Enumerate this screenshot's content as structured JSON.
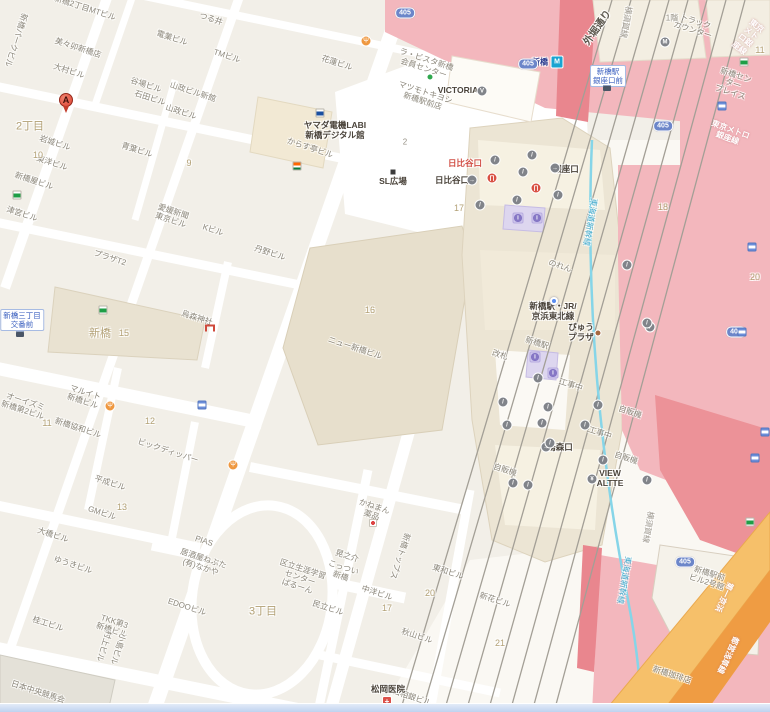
{
  "map": {
    "route_shield_label": "405",
    "metro_badge": {
      "glyph": "M",
      "x": 557,
      "y": 62
    },
    "route_shields": [
      {
        "x": 405,
        "y": 13
      },
      {
        "x": 528,
        "y": 64
      },
      {
        "x": 663,
        "y": 126
      },
      {
        "x": 736,
        "y": 332
      },
      {
        "x": 685,
        "y": 562
      }
    ],
    "labels": [
      {
        "t": "新橋2丁目MTビル",
        "x": 85,
        "y": 8
      },
      {
        "t": "美々卯新橋店",
        "x": 78,
        "y": 48
      },
      {
        "t": "大村ビル",
        "x": 69,
        "y": 71
      },
      {
        "t": "新橋パークビル",
        "x": 16,
        "y": 40,
        "r": 108
      },
      {
        "t": "電業ビル",
        "x": 172,
        "y": 38
      },
      {
        "t": "谷場ビル",
        "x": 146,
        "y": 85
      },
      {
        "t": "石田ビル",
        "x": 150,
        "y": 98
      },
      {
        "t": "山政ビル新館",
        "x": 193,
        "y": 92
      },
      {
        "t": "山政ビル",
        "x": 181,
        "y": 112
      },
      {
        "t": "青葉ビル",
        "x": 137,
        "y": 150
      },
      {
        "t": "岩城ビル",
        "x": 55,
        "y": 143
      },
      {
        "t": "東洋ビル",
        "x": 52,
        "y": 163
      },
      {
        "t": "新橋屋ビル",
        "x": 34,
        "y": 181
      },
      {
        "t": "津宮ビル",
        "x": 22,
        "y": 214
      },
      {
        "t": "Kビル",
        "x": 213,
        "y": 230
      },
      {
        "t": "愛媛新聞\n東京ビル",
        "x": 172,
        "y": 216
      },
      {
        "t": "つる井",
        "x": 211,
        "y": 19
      },
      {
        "t": "TMビル",
        "x": 227,
        "y": 56
      },
      {
        "t": "花蓮ビル",
        "x": 337,
        "y": 63
      },
      {
        "t": "からす亭ビル",
        "x": 310,
        "y": 148
      },
      {
        "t": "プラザT2",
        "x": 110,
        "y": 258
      },
      {
        "t": "マルイト\n新橋ビル",
        "x": 84,
        "y": 397
      },
      {
        "t": "オーイズミ\n新橋第2ビル",
        "x": 24,
        "y": 406
      },
      {
        "t": "ビックディッパー",
        "x": 168,
        "y": 451
      },
      {
        "t": "新橋協和ビル",
        "x": 78,
        "y": 428
      },
      {
        "t": "GMビル",
        "x": 102,
        "y": 513
      },
      {
        "t": "平成ビル",
        "x": 110,
        "y": 483
      },
      {
        "t": "大橋ビル",
        "x": 53,
        "y": 535
      },
      {
        "t": "ゆうきビル",
        "x": 73,
        "y": 565
      },
      {
        "t": "桂工ビル",
        "x": 48,
        "y": 624
      },
      {
        "t": "TKK第3\n新橋ビル",
        "x": 113,
        "y": 626
      },
      {
        "t": "村上ビル",
        "x": 104,
        "y": 646,
        "r": 108
      },
      {
        "t": "小島ビル",
        "x": 118,
        "y": 649,
        "r": 108
      },
      {
        "t": "日本中央競馬会",
        "x": 38,
        "y": 692
      },
      {
        "t": "EDOOビル",
        "x": 187,
        "y": 607
      },
      {
        "t": "PIAS",
        "x": 204,
        "y": 541
      },
      {
        "t": "居酒屋ねぶた\n(有)なかや",
        "x": 202,
        "y": 563
      },
      {
        "t": "かねまん\n薬品",
        "x": 373,
        "y": 511
      },
      {
        "t": "新橋トップス",
        "x": 400,
        "y": 556,
        "r": 108
      },
      {
        "t": "東和ビル",
        "x": 448,
        "y": 572
      },
      {
        "t": "中洋ビル",
        "x": 377,
        "y": 593
      },
      {
        "t": "秋山ビル",
        "x": 417,
        "y": 636
      },
      {
        "t": "新花ビル",
        "x": 495,
        "y": 600
      },
      {
        "t": "西口相銀ビル",
        "x": 408,
        "y": 696
      },
      {
        "t": "区立生涯学習\nセンター\nばるーん",
        "x": 300,
        "y": 578
      },
      {
        "t": "こっつい\n新橋",
        "x": 342,
        "y": 572
      },
      {
        "t": "晃之介",
        "x": 347,
        "y": 556
      },
      {
        "t": "民立ビル",
        "x": 328,
        "y": 608
      },
      {
        "t": "ニュー新橋ビル",
        "x": 355,
        "y": 348
      },
      {
        "t": "丹野ビル",
        "x": 270,
        "y": 253
      },
      {
        "t": "新橋駅前\nビル2号館",
        "x": 708,
        "y": 578
      },
      {
        "t": "新橋センター\nプレイス",
        "x": 733,
        "y": 84
      },
      {
        "t": "トラック\nカウンター",
        "x": 694,
        "y": 26
      },
      {
        "t": "ラ・ビスタ新橋\n会員センター",
        "x": 425,
        "y": 64
      },
      {
        "t": "マツモトキヨシ\n新橋駅前店",
        "x": 424,
        "y": 97
      },
      {
        "t": "新橋珈琲店",
        "x": 672,
        "y": 675
      },
      {
        "t": "のれん",
        "x": 560,
        "y": 266
      },
      {
        "t": "新橋駅",
        "x": 537,
        "y": 343
      },
      {
        "t": "改札",
        "x": 500,
        "y": 355
      },
      {
        "t": "工事中",
        "x": 571,
        "y": 385
      },
      {
        "t": "工事中",
        "x": 600,
        "y": 433
      },
      {
        "t": "自販機",
        "x": 630,
        "y": 412
      },
      {
        "t": "自販機",
        "x": 626,
        "y": 458
      },
      {
        "t": "自販機",
        "x": 505,
        "y": 470
      },
      {
        "t": "烏森神社",
        "x": 197,
        "y": 318
      },
      {
        "t": "ヤマダ電機LABI\n新橋デジタル館",
        "x": 335,
        "y": 131,
        "s": "p"
      },
      {
        "t": "SL広場",
        "x": 393,
        "y": 182,
        "s": "p"
      },
      {
        "t": "VICTORIA",
        "x": 458,
        "y": 91,
        "s": "p"
      },
      {
        "t": "日比谷口",
        "x": 452,
        "y": 181,
        "s": "p"
      },
      {
        "t": "銀座口",
        "x": 566,
        "y": 170,
        "s": "p"
      },
      {
        "t": "烏森口",
        "x": 560,
        "y": 448,
        "s": "p"
      },
      {
        "t": "新橋駅・JR/\n京浜東北線",
        "x": 553,
        "y": 312,
        "s": "p"
      },
      {
        "t": "びゅう\nプラザ",
        "x": 581,
        "y": 333,
        "s": "p"
      },
      {
        "t": "VIEW\nALTTE",
        "x": 610,
        "y": 479,
        "s": "p"
      },
      {
        "t": "松岡医院",
        "x": 388,
        "y": 690,
        "s": "p"
      },
      {
        "t": "日比谷口",
        "x": 465,
        "y": 164,
        "s": "er"
      },
      {
        "t": "2丁目",
        "x": 30,
        "y": 127,
        "s": "d"
      },
      {
        "t": "新橋",
        "x": 100,
        "y": 334,
        "s": "d"
      },
      {
        "t": "3丁目",
        "x": 263,
        "y": 612,
        "s": "d"
      },
      {
        "t": "10",
        "x": 38,
        "y": 155,
        "s": "n"
      },
      {
        "t": "9",
        "x": 189,
        "y": 163,
        "s": "n"
      },
      {
        "t": "15",
        "x": 124,
        "y": 333,
        "s": "n"
      },
      {
        "t": "16",
        "x": 370,
        "y": 310,
        "s": "n"
      },
      {
        "t": "11",
        "x": 47,
        "y": 423,
        "s": "n"
      },
      {
        "t": "12",
        "x": 150,
        "y": 421,
        "s": "n"
      },
      {
        "t": "13",
        "x": 122,
        "y": 507,
        "s": "n"
      },
      {
        "t": "17",
        "x": 459,
        "y": 208,
        "s": "n"
      },
      {
        "t": "17",
        "x": 387,
        "y": 608,
        "s": "n"
      },
      {
        "t": "20",
        "x": 430,
        "y": 593,
        "s": "n"
      },
      {
        "t": "21",
        "x": 500,
        "y": 643,
        "s": "n"
      },
      {
        "t": "18",
        "x": 663,
        "y": 207,
        "s": "n"
      },
      {
        "t": "20",
        "x": 755,
        "y": 277,
        "s": "n"
      },
      {
        "t": "11",
        "x": 760,
        "y": 50,
        "s": "n"
      },
      {
        "t": "1階",
        "x": 672,
        "y": 18,
        "s": "g"
      },
      {
        "t": "2",
        "x": 405,
        "y": 142,
        "s": "g"
      },
      {
        "t": "外堀通り",
        "x": 598,
        "y": 28,
        "s": "st",
        "r": -55
      },
      {
        "t": "横須賀線",
        "x": 626,
        "y": 22,
        "s": "rl",
        "r": 100
      },
      {
        "t": "横須賀線",
        "x": 648,
        "y": 527,
        "s": "rl",
        "r": 100
      },
      {
        "t": "東海道新幹線",
        "x": 590,
        "y": 222,
        "s": "rb",
        "r": 100
      },
      {
        "t": "東海道新幹線",
        "x": 624,
        "y": 580,
        "s": "rb",
        "r": 100
      },
      {
        "t": "東京メトロ銀座線",
        "x": 748,
        "y": 37,
        "s": "rw",
        "r": 38
      },
      {
        "t": "東京メトロ銀座線",
        "x": 729,
        "y": 134,
        "s": "rw",
        "r": 20
      },
      {
        "t": "第一京浜",
        "x": 724,
        "y": 597,
        "s": "rw",
        "r": 115
      },
      {
        "t": "都営浅草線",
        "x": 728,
        "y": 655,
        "s": "rw",
        "r": 115
      },
      {
        "t": "新橋",
        "x": 540,
        "y": 62,
        "s": "mt"
      },
      {
        "t": "新橋三丁目\n交番前",
        "x": 22,
        "y": 320,
        "s": "bus"
      },
      {
        "t": "新橋駅\n銀座口前",
        "x": 608,
        "y": 76,
        "s": "bus"
      }
    ],
    "icons": [
      {
        "t": "pin",
        "g": "A",
        "x": 66,
        "y": 100
      },
      {
        "t": "grn",
        "x": 17,
        "y": 195
      },
      {
        "t": "grn",
        "x": 103,
        "y": 310
      },
      {
        "t": "grn",
        "x": 744,
        "y": 62
      },
      {
        "t": "grn",
        "x": 750,
        "y": 522
      },
      {
        "t": "dgr",
        "x": 430,
        "y": 77
      },
      {
        "t": "sev",
        "x": 297,
        "y": 166
      },
      {
        "t": "res",
        "g": "Ψ",
        "x": 366,
        "y": 41
      },
      {
        "t": "res",
        "g": "Ψ",
        "x": 110,
        "y": 406
      },
      {
        "t": "res",
        "g": "Ψ",
        "x": 233,
        "y": 465
      },
      {
        "t": "tor",
        "x": 210,
        "y": 328
      },
      {
        "t": "hos",
        "g": "+",
        "x": 387,
        "y": 701
      },
      {
        "t": "cli",
        "x": 373,
        "y": 523
      },
      {
        "t": "bus",
        "x": 20,
        "y": 334
      },
      {
        "t": "bus",
        "x": 607,
        "y": 88
      },
      {
        "t": "dbl",
        "x": 554,
        "y": 301
      },
      {
        "t": "dbr",
        "x": 598,
        "y": 333
      },
      {
        "t": "bsq",
        "x": 393,
        "y": 172
      },
      {
        "t": "sto",
        "x": 320,
        "y": 113
      },
      {
        "t": "gat",
        "g": "∏",
        "x": 492,
        "y": 178
      },
      {
        "t": "gat",
        "g": "∏",
        "x": 536,
        "y": 188
      },
      {
        "t": "inf",
        "g": "i",
        "x": 518,
        "y": 218
      },
      {
        "t": "inf",
        "g": "i",
        "x": 537,
        "y": 218
      },
      {
        "t": "inf",
        "g": "i",
        "x": 535,
        "y": 357
      },
      {
        "t": "inf",
        "g": "i",
        "x": 553,
        "y": 373
      },
      {
        "t": "sqb",
        "x": 202,
        "y": 405
      },
      {
        "t": "sqb",
        "x": 722,
        "y": 106
      },
      {
        "t": "sqb",
        "x": 752,
        "y": 247
      },
      {
        "t": "sqb",
        "x": 742,
        "y": 332
      },
      {
        "t": "sqb",
        "x": 765,
        "y": 432
      },
      {
        "t": "sqb",
        "x": 755,
        "y": 458
      },
      {
        "t": "cg",
        "g": "→",
        "x": 472,
        "y": 180
      },
      {
        "t": "cg",
        "g": "→",
        "x": 555,
        "y": 168
      },
      {
        "t": "cg",
        "g": "→",
        "x": 546,
        "y": 447
      },
      {
        "t": "cg",
        "g": "¥",
        "x": 592,
        "y": 479
      },
      {
        "t": "cg",
        "g": "M",
        "x": 665,
        "y": 42
      },
      {
        "t": "cg",
        "g": "V",
        "x": 482,
        "y": 91
      },
      {
        "t": "cg",
        "g": "/",
        "x": 495,
        "y": 160
      },
      {
        "t": "cg",
        "g": "/",
        "x": 532,
        "y": 155
      },
      {
        "t": "cg",
        "g": "/",
        "x": 523,
        "y": 172
      },
      {
        "t": "cg",
        "g": "/",
        "x": 480,
        "y": 205
      },
      {
        "t": "cg",
        "g": "/",
        "x": 517,
        "y": 200
      },
      {
        "t": "cg",
        "g": "/",
        "x": 558,
        "y": 195
      },
      {
        "t": "cg",
        "g": "/",
        "x": 538,
        "y": 378
      },
      {
        "t": "cg",
        "g": "/",
        "x": 503,
        "y": 402
      },
      {
        "t": "cg",
        "g": "/",
        "x": 548,
        "y": 407
      },
      {
        "t": "cg",
        "g": "/",
        "x": 598,
        "y": 405
      },
      {
        "t": "cg",
        "g": "/",
        "x": 507,
        "y": 425
      },
      {
        "t": "cg",
        "g": "/",
        "x": 542,
        "y": 423
      },
      {
        "t": "cg",
        "g": "/",
        "x": 585,
        "y": 425
      },
      {
        "t": "cg",
        "g": "/",
        "x": 550,
        "y": 443
      },
      {
        "t": "cg",
        "g": "/",
        "x": 603,
        "y": 460
      },
      {
        "t": "cg",
        "g": "/",
        "x": 513,
        "y": 483
      },
      {
        "t": "cg",
        "g": "/",
        "x": 528,
        "y": 485
      },
      {
        "t": "cg",
        "g": "/",
        "x": 647,
        "y": 480
      },
      {
        "t": "cg",
        "g": "/",
        "x": 650,
        "y": 327
      },
      {
        "t": "cg",
        "g": "/",
        "x": 627,
        "y": 265
      },
      {
        "t": "cg",
        "g": "/",
        "x": 647,
        "y": 323
      }
    ]
  }
}
